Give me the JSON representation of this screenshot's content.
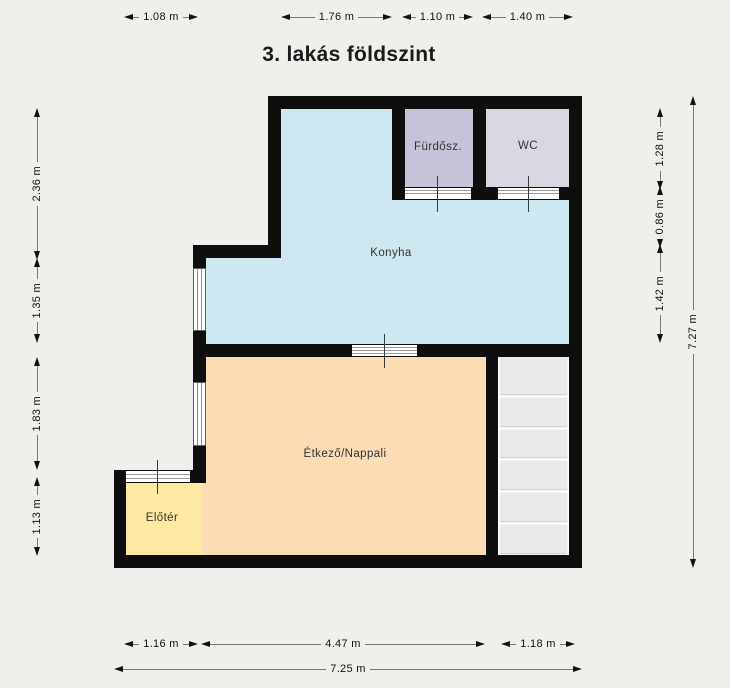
{
  "title": "3. lakás földszint",
  "rooms": {
    "konyha": {
      "label": "Konyha",
      "color": "#cde8f0"
    },
    "furdosz": {
      "label": "Fürdősz.",
      "color": "#c5c3d7"
    },
    "wc": {
      "label": "WC",
      "color": "#d8d7e2"
    },
    "etkezo": {
      "label": "Étkező/Nappali",
      "color": "#fcdcb4"
    },
    "eloter": {
      "label": "Előtér",
      "color": "#fde9a2"
    }
  },
  "dimensions": {
    "top": [
      {
        "label": "1.08 m"
      },
      {
        "label": "1.76 m"
      },
      {
        "label": "1.10 m"
      },
      {
        "label": "1.40 m"
      }
    ],
    "left": [
      {
        "label": "2.36 m"
      },
      {
        "label": "1.35 m"
      },
      {
        "label": "1.83 m"
      },
      {
        "label": "1.13 m"
      }
    ],
    "right": [
      {
        "label": "1.28 m"
      },
      {
        "label": "0.86 m"
      },
      {
        "label": "1.42 m"
      }
    ],
    "right_total": {
      "label": "7.27 m"
    },
    "bottom": [
      {
        "label": "1.16 m"
      },
      {
        "label": "4.47 m"
      },
      {
        "label": "1.18 m"
      }
    ],
    "bottom_total": {
      "label": "7.25 m"
    }
  },
  "colors": {
    "background": "#f0efeb",
    "wall": "#0e0e0e",
    "stairs_step": "#eaeae8",
    "dimension_line": "#777777",
    "text": "#111111"
  }
}
